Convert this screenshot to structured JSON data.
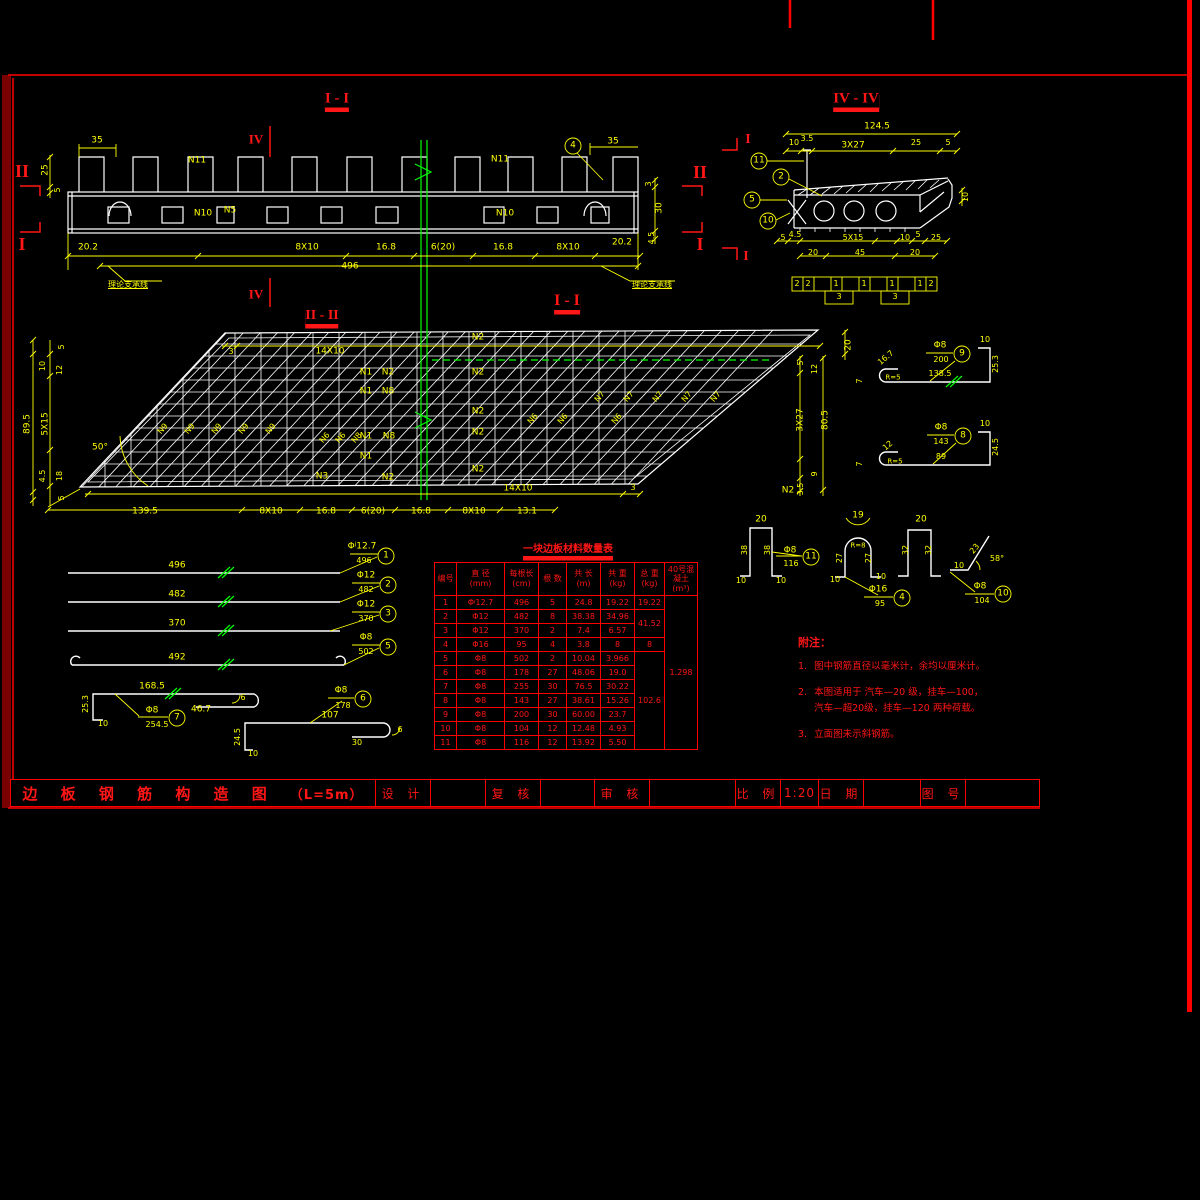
{
  "title_block": {
    "drawing_title": "边 板 钢 筋 构 造 图",
    "drawing_subtitle": "（L=5m）",
    "fields": [
      {
        "label": "设 计",
        "value": ""
      },
      {
        "label": "复 核",
        "value": ""
      },
      {
        "label": "审 核",
        "value": ""
      },
      {
        "label": "比 例",
        "value": "1:20"
      },
      {
        "label": "日 期",
        "value": ""
      },
      {
        "label": "图 号",
        "value": ""
      }
    ]
  },
  "table": {
    "title": "一块边板材料数量表",
    "headers": [
      "编号",
      "直 径\n(mm)",
      "每根长\n(cm)",
      "根 数",
      "共 长\n(m)",
      "共 重\n(kg)",
      "总 重\n(kg)",
      "40号混凝土\n(m³)"
    ],
    "rows": [
      [
        "1",
        "Φʲ12.7",
        "496",
        "5",
        "24.8",
        "19.22",
        {
          "t": "19.22"
        },
        {
          "t": "1.298",
          "rs": 11
        }
      ],
      [
        "2",
        "Φ12",
        "482",
        "8",
        "38.38",
        "34.96",
        {
          "t": "41.52",
          "rs": 2
        }
      ],
      [
        "3",
        "Φ12",
        "370",
        "2",
        "7.4",
        "6.57"
      ],
      [
        "4",
        "Φ16",
        "95",
        "4",
        "3.8",
        "8",
        {
          "t": "8"
        }
      ],
      [
        "5",
        "Φ8",
        "502",
        "2",
        "10.04",
        "3.966",
        {
          "t": "102.6",
          "rs": 7
        }
      ],
      [
        "6",
        "Φ8",
        "178",
        "27",
        "48.06",
        "19.0"
      ],
      [
        "7",
        "Φ8",
        "255",
        "30",
        "76.5",
        "30.22"
      ],
      [
        "8",
        "Φ8",
        "143",
        "27",
        "38.61",
        "15.26"
      ],
      [
        "9",
        "Φ8",
        "200",
        "30",
        "60.00",
        "23.7"
      ],
      [
        "10",
        "Φ8",
        "104",
        "12",
        "12.48",
        "4.93"
      ],
      [
        "11",
        "Φ8",
        "116",
        "12",
        "13.92",
        "5.50"
      ]
    ]
  },
  "notes": {
    "heading": "附注：",
    "items": [
      {
        "num": "1.",
        "text": "图中钢筋直径以毫米计，余均以厘米计。"
      },
      {
        "num": "2.",
        "text": "本图适用于 汽车—20 级，挂车—100，\n汽车—超20级，挂车—120 两种荷载。"
      },
      {
        "num": "3.",
        "text": "立面图未示斜钢筋。"
      }
    ]
  },
  "colors": {
    "background": "#000000",
    "linework": "#ffffff",
    "dimension": "#ffff00",
    "accent": "#ff0000",
    "breakline": "#00ff00",
    "frame_dark": "#7a0101"
  },
  "annotations": [
    {
      "x": 337,
      "y": 100,
      "t": "I - I",
      "c": "r",
      "s": 15,
      "b": 1,
      "f": 1,
      "u": 2,
      "n": "view-title-elevation"
    },
    {
      "x": 856,
      "y": 100,
      "t": "IV - IV",
      "c": "r",
      "s": 15,
      "b": 1,
      "f": 1,
      "u": 2,
      "n": "view-title-section-iv"
    },
    {
      "x": 322,
      "y": 317,
      "t": "II - II",
      "c": "r",
      "s": 14,
      "b": 1,
      "f": 1,
      "u": 2,
      "n": "view-title-plan"
    },
    {
      "x": 567,
      "y": 302,
      "t": "I - I",
      "c": "r",
      "s": 16,
      "b": 1,
      "f": 1,
      "u": 2,
      "n": "section-cut-title"
    },
    {
      "x": 22,
      "y": 171,
      "t": "II",
      "c": "r",
      "s": 18,
      "b": 1,
      "f": 1,
      "n": "section-marker"
    },
    {
      "x": 22,
      "y": 244,
      "t": "I",
      "c": "r",
      "s": 18,
      "b": 1,
      "f": 1,
      "n": "section-marker"
    },
    {
      "x": 700,
      "y": 172,
      "t": "II",
      "c": "r",
      "s": 18,
      "b": 1,
      "f": 1,
      "n": "section-marker"
    },
    {
      "x": 700,
      "y": 244,
      "t": "I",
      "c": "r",
      "s": 18,
      "b": 1,
      "f": 1,
      "n": "section-marker"
    },
    {
      "x": 256,
      "y": 139,
      "t": "IV",
      "c": "r",
      "s": 13,
      "b": 1,
      "f": 1,
      "n": "section-marker"
    },
    {
      "x": 256,
      "y": 294,
      "t": "IV",
      "c": "r",
      "s": 13,
      "b": 1,
      "f": 1,
      "n": "section-marker"
    },
    {
      "x": 748,
      "y": 140,
      "t": "I",
      "c": "r",
      "s": 14,
      "b": 1,
      "f": 1,
      "n": "section-marker"
    },
    {
      "x": 746,
      "y": 257,
      "t": "I",
      "c": "r",
      "s": 14,
      "b": 1,
      "f": 1,
      "n": "section-marker"
    },
    {
      "x": 97,
      "y": 141,
      "t": "35"
    },
    {
      "x": 46,
      "y": 170,
      "t": "25",
      "r": -90
    },
    {
      "x": 58,
      "y": 190,
      "t": "5",
      "r": -90,
      "s": 8
    },
    {
      "x": 613,
      "y": 142,
      "t": "35"
    },
    {
      "x": 649,
      "y": 184,
      "t": "3",
      "r": -90,
      "s": 8
    },
    {
      "x": 660,
      "y": 208,
      "t": "30",
      "r": -90
    },
    {
      "x": 652,
      "y": 238,
      "t": "4.5",
      "r": -90,
      "s": 8
    },
    {
      "x": 88,
      "y": 248,
      "t": "20.2"
    },
    {
      "x": 307,
      "y": 248,
      "t": "8X10"
    },
    {
      "x": 386,
      "y": 248,
      "t": "16.8"
    },
    {
      "x": 443,
      "y": 248,
      "t": "6(20)"
    },
    {
      "x": 503,
      "y": 248,
      "t": "16.8"
    },
    {
      "x": 568,
      "y": 248,
      "t": "8X10"
    },
    {
      "x": 622,
      "y": 243,
      "t": "20.2"
    },
    {
      "x": 350,
      "y": 267,
      "t": "496"
    },
    {
      "x": 197,
      "y": 161,
      "t": "N11",
      "n": "bar-label"
    },
    {
      "x": 203,
      "y": 214,
      "t": "N10",
      "n": "bar-label"
    },
    {
      "x": 230,
      "y": 211,
      "t": "N5",
      "n": "bar-label"
    },
    {
      "x": 500,
      "y": 160,
      "t": "N11",
      "n": "bar-label"
    },
    {
      "x": 505,
      "y": 214,
      "t": "N10",
      "n": "bar-label"
    },
    {
      "x": 128,
      "y": 285,
      "t": "理论支承线",
      "s": 8,
      "u": 1,
      "n": "support-line-label"
    },
    {
      "x": 652,
      "y": 285,
      "t": "理论支承线",
      "s": 8,
      "u": 1,
      "n": "support-line-label"
    },
    {
      "x": 573,
      "y": 146,
      "t": "4",
      "n": "callout-number"
    },
    {
      "x": 877,
      "y": 127,
      "t": "124.5"
    },
    {
      "x": 794,
      "y": 143,
      "t": "10",
      "s": 8
    },
    {
      "x": 807,
      "y": 139,
      "t": "3.5",
      "s": 8
    },
    {
      "x": 853,
      "y": 146,
      "t": "3X27"
    },
    {
      "x": 916,
      "y": 143,
      "t": "25",
      "s": 8
    },
    {
      "x": 948,
      "y": 143,
      "t": "5",
      "s": 8
    },
    {
      "x": 966,
      "y": 197,
      "t": "10",
      "r": -90,
      "s": 8
    },
    {
      "x": 759,
      "y": 161,
      "t": "11",
      "n": "callout-number"
    },
    {
      "x": 781,
      "y": 177,
      "t": "2",
      "n": "callout-number"
    },
    {
      "x": 752,
      "y": 200,
      "t": "5",
      "n": "callout-number"
    },
    {
      "x": 768,
      "y": 221,
      "t": "10",
      "n": "callout-number"
    },
    {
      "x": 783,
      "y": 238,
      "t": "5",
      "s": 8
    },
    {
      "x": 795,
      "y": 235,
      "t": "4.5",
      "s": 8
    },
    {
      "x": 853,
      "y": 238,
      "t": "5X15",
      "s": 8
    },
    {
      "x": 905,
      "y": 238,
      "t": "10",
      "s": 8
    },
    {
      "x": 918,
      "y": 235,
      "t": "5",
      "s": 8
    },
    {
      "x": 936,
      "y": 238,
      "t": "25",
      "s": 8
    },
    {
      "x": 813,
      "y": 253,
      "t": "20",
      "s": 8
    },
    {
      "x": 860,
      "y": 253,
      "t": "45",
      "s": 8
    },
    {
      "x": 915,
      "y": 253,
      "t": "20",
      "s": 8
    },
    {
      "x": 797,
      "y": 284,
      "t": "2",
      "s": 8
    },
    {
      "x": 808,
      "y": 284,
      "t": "2",
      "s": 8
    },
    {
      "x": 836,
      "y": 284,
      "t": "1",
      "s": 8
    },
    {
      "x": 864,
      "y": 284,
      "t": "1",
      "s": 8
    },
    {
      "x": 892,
      "y": 284,
      "t": "1",
      "s": 8
    },
    {
      "x": 920,
      "y": 284,
      "t": "1",
      "s": 8
    },
    {
      "x": 931,
      "y": 284,
      "t": "2",
      "s": 8
    },
    {
      "x": 839,
      "y": 297,
      "t": "3",
      "s": 8
    },
    {
      "x": 895,
      "y": 297,
      "t": "3",
      "s": 8
    },
    {
      "x": 100,
      "y": 448,
      "t": "50°"
    },
    {
      "x": 231,
      "y": 352,
      "t": "3",
      "s": 8
    },
    {
      "x": 330,
      "y": 352,
      "t": "14X10"
    },
    {
      "x": 518,
      "y": 489,
      "t": "14X10"
    },
    {
      "x": 633,
      "y": 488,
      "t": "3",
      "s": 8
    },
    {
      "x": 145,
      "y": 512,
      "t": "139.5"
    },
    {
      "x": 271,
      "y": 512,
      "t": "8X10"
    },
    {
      "x": 326,
      "y": 512,
      "t": "16.8"
    },
    {
      "x": 373,
      "y": 512,
      "t": "6(20)"
    },
    {
      "x": 421,
      "y": 512,
      "t": "16.8"
    },
    {
      "x": 474,
      "y": 512,
      "t": "8X10"
    },
    {
      "x": 527,
      "y": 512,
      "t": "13.1"
    },
    {
      "x": 62,
      "y": 347,
      "t": "5",
      "r": -90,
      "s": 8
    },
    {
      "x": 43,
      "y": 366,
      "t": "10",
      "r": -90,
      "s": 8
    },
    {
      "x": 60,
      "y": 370,
      "t": "12",
      "r": -90,
      "s": 8
    },
    {
      "x": 28,
      "y": 424,
      "t": "89.5",
      "r": -90
    },
    {
      "x": 46,
      "y": 424,
      "t": "5X15",
      "r": -90
    },
    {
      "x": 43,
      "y": 476,
      "t": "4.5",
      "r": -90,
      "s": 8
    },
    {
      "x": 60,
      "y": 476,
      "t": "18",
      "r": -90,
      "s": 8
    },
    {
      "x": 62,
      "y": 498,
      "t": "5",
      "r": -90,
      "s": 8
    },
    {
      "x": 849,
      "y": 345,
      "t": "20",
      "r": -90
    },
    {
      "x": 801,
      "y": 363,
      "t": "5",
      "r": -90,
      "s": 8
    },
    {
      "x": 815,
      "y": 369,
      "t": "12",
      "r": -90,
      "s": 8
    },
    {
      "x": 801,
      "y": 420,
      "t": "3X27",
      "r": -90
    },
    {
      "x": 826,
      "y": 420,
      "t": "80.5",
      "r": -90
    },
    {
      "x": 815,
      "y": 474,
      "t": "9",
      "r": -90,
      "s": 8
    },
    {
      "x": 801,
      "y": 489,
      "t": "3.5",
      "r": -90,
      "s": 8
    },
    {
      "x": 366,
      "y": 373,
      "t": "N1",
      "n": "bar-label"
    },
    {
      "x": 388,
      "y": 373,
      "t": "N2",
      "n": "bar-label"
    },
    {
      "x": 366,
      "y": 392,
      "t": "N1",
      "n": "bar-label"
    },
    {
      "x": 388,
      "y": 392,
      "t": "N8",
      "n": "bar-label"
    },
    {
      "x": 366,
      "y": 437,
      "t": "N1",
      "n": "bar-label"
    },
    {
      "x": 389,
      "y": 437,
      "t": "N8",
      "n": "bar-label"
    },
    {
      "x": 366,
      "y": 457,
      "t": "N1",
      "n": "bar-label"
    },
    {
      "x": 322,
      "y": 477,
      "t": "N3",
      "n": "bar-label"
    },
    {
      "x": 388,
      "y": 478,
      "t": "N2",
      "n": "bar-label"
    },
    {
      "x": 478,
      "y": 338,
      "t": "N2",
      "n": "bar-label"
    },
    {
      "x": 478,
      "y": 373,
      "t": "N2",
      "n": "bar-label"
    },
    {
      "x": 478,
      "y": 412,
      "t": "N2",
      "n": "bar-label"
    },
    {
      "x": 478,
      "y": 433,
      "t": "N2",
      "n": "bar-label"
    },
    {
      "x": 478,
      "y": 470,
      "t": "N2",
      "n": "bar-label"
    },
    {
      "x": 788,
      "y": 491,
      "t": "N2",
      "n": "bar-label"
    },
    {
      "x": 163,
      "y": 429,
      "t": "N9",
      "r": -50,
      "s": 8,
      "n": "bar-label"
    },
    {
      "x": 190,
      "y": 429,
      "t": "N9",
      "r": -50,
      "s": 8,
      "n": "bar-label"
    },
    {
      "x": 217,
      "y": 429,
      "t": "N9",
      "r": -50,
      "s": 8,
      "n": "bar-label"
    },
    {
      "x": 244,
      "y": 429,
      "t": "N9",
      "r": -50,
      "s": 8,
      "n": "bar-label"
    },
    {
      "x": 271,
      "y": 429,
      "t": "N9",
      "r": -50,
      "s": 8,
      "n": "bar-label"
    },
    {
      "x": 325,
      "y": 438,
      "t": "N6",
      "r": -50,
      "s": 8,
      "n": "bar-label"
    },
    {
      "x": 341,
      "y": 438,
      "t": "N6",
      "r": -50,
      "s": 8,
      "n": "bar-label"
    },
    {
      "x": 357,
      "y": 438,
      "t": "N8",
      "r": -50,
      "s": 8,
      "n": "bar-label"
    },
    {
      "x": 533,
      "y": 419,
      "t": "N6",
      "r": -50,
      "s": 8,
      "n": "bar-label"
    },
    {
      "x": 563,
      "y": 419,
      "t": "N6",
      "r": -50,
      "s": 8,
      "n": "bar-label"
    },
    {
      "x": 617,
      "y": 419,
      "t": "N6",
      "r": -50,
      "s": 8,
      "n": "bar-label"
    },
    {
      "x": 600,
      "y": 397,
      "t": "N7",
      "r": -50,
      "s": 8,
      "n": "bar-label"
    },
    {
      "x": 629,
      "y": 397,
      "t": "N7",
      "r": -50,
      "s": 8,
      "n": "bar-label"
    },
    {
      "x": 658,
      "y": 397,
      "t": "N7",
      "r": -50,
      "s": 8,
      "n": "bar-label"
    },
    {
      "x": 687,
      "y": 397,
      "t": "N7",
      "r": -50,
      "s": 8,
      "n": "bar-label"
    },
    {
      "x": 716,
      "y": 397,
      "t": "N7",
      "r": -50,
      "s": 8,
      "n": "bar-label"
    },
    {
      "x": 177,
      "y": 566,
      "t": "496"
    },
    {
      "x": 177,
      "y": 595,
      "t": "482"
    },
    {
      "x": 177,
      "y": 624,
      "t": "370"
    },
    {
      "x": 177,
      "y": 658,
      "t": "492"
    },
    {
      "x": 362,
      "y": 547,
      "t": "Φʲ12.7"
    },
    {
      "x": 364,
      "y": 561,
      "t": "496",
      "s": 8
    },
    {
      "x": 386,
      "y": 556,
      "t": "1",
      "n": "callout-number"
    },
    {
      "x": 366,
      "y": 576,
      "t": "Φ12"
    },
    {
      "x": 366,
      "y": 590,
      "t": "482",
      "s": 8
    },
    {
      "x": 388,
      "y": 585,
      "t": "2",
      "n": "callout-number"
    },
    {
      "x": 366,
      "y": 605,
      "t": "Φ12"
    },
    {
      "x": 366,
      "y": 619,
      "t": "370",
      "s": 8
    },
    {
      "x": 388,
      "y": 614,
      "t": "3",
      "n": "callout-number"
    },
    {
      "x": 366,
      "y": 638,
      "t": "Φ8"
    },
    {
      "x": 366,
      "y": 652,
      "t": "502",
      "s": 8
    },
    {
      "x": 388,
      "y": 647,
      "t": "5",
      "n": "callout-number"
    },
    {
      "x": 152,
      "y": 687,
      "t": "168.5"
    },
    {
      "x": 201,
      "y": 710,
      "t": "46.7"
    },
    {
      "x": 243,
      "y": 698,
      "t": "6",
      "s": 8
    },
    {
      "x": 86,
      "y": 704,
      "t": "25.3",
      "r": -90,
      "s": 8
    },
    {
      "x": 103,
      "y": 724,
      "t": "10",
      "s": 8
    },
    {
      "x": 152,
      "y": 711,
      "t": "Φ8"
    },
    {
      "x": 157,
      "y": 725,
      "t": "254.5",
      "s": 8
    },
    {
      "x": 177,
      "y": 718,
      "t": "7",
      "n": "callout-number"
    },
    {
      "x": 330,
      "y": 716,
      "t": "107"
    },
    {
      "x": 357,
      "y": 743,
      "t": "30",
      "s": 8
    },
    {
      "x": 400,
      "y": 730,
      "t": "6",
      "s": 8
    },
    {
      "x": 238,
      "y": 737,
      "t": "24.5",
      "r": -90,
      "s": 8
    },
    {
      "x": 253,
      "y": 754,
      "t": "10",
      "s": 8
    },
    {
      "x": 341,
      "y": 691,
      "t": "Φ8"
    },
    {
      "x": 343,
      "y": 706,
      "t": "178",
      "s": 8
    },
    {
      "x": 363,
      "y": 699,
      "t": "6",
      "n": "callout-number"
    },
    {
      "x": 940,
      "y": 346,
      "t": "Φ8"
    },
    {
      "x": 941,
      "y": 360,
      "t": "200",
      "s": 8
    },
    {
      "x": 962,
      "y": 354,
      "t": "9",
      "n": "callout-number"
    },
    {
      "x": 985,
      "y": 340,
      "t": "10",
      "s": 8
    },
    {
      "x": 996,
      "y": 364,
      "t": "25.3",
      "r": -90,
      "s": 8
    },
    {
      "x": 940,
      "y": 374,
      "t": "138.5",
      "s": 8
    },
    {
      "x": 886,
      "y": 358,
      "t": "16.7",
      "r": -40,
      "s": 8
    },
    {
      "x": 893,
      "y": 378,
      "t": "R=5",
      "s": 7
    },
    {
      "x": 860,
      "y": 381,
      "t": "7",
      "r": -90,
      "s": 8
    },
    {
      "x": 941,
      "y": 428,
      "t": "Φ8"
    },
    {
      "x": 941,
      "y": 442,
      "t": "143",
      "s": 8
    },
    {
      "x": 963,
      "y": 436,
      "t": "8",
      "n": "callout-number"
    },
    {
      "x": 985,
      "y": 424,
      "t": "10",
      "s": 8
    },
    {
      "x": 996,
      "y": 447,
      "t": "24.5",
      "r": -90,
      "s": 8
    },
    {
      "x": 941,
      "y": 457,
      "t": "89",
      "s": 8
    },
    {
      "x": 888,
      "y": 446,
      "t": "12",
      "r": -40,
      "s": 8
    },
    {
      "x": 895,
      "y": 462,
      "t": "R=5",
      "s": 7
    },
    {
      "x": 860,
      "y": 464,
      "t": "7",
      "r": -90,
      "s": 8
    },
    {
      "x": 761,
      "y": 520,
      "t": "20"
    },
    {
      "x": 745,
      "y": 550,
      "t": "38",
      "r": -90,
      "s": 8
    },
    {
      "x": 768,
      "y": 550,
      "t": "38",
      "r": -90,
      "s": 8
    },
    {
      "x": 741,
      "y": 581,
      "t": "10",
      "s": 8
    },
    {
      "x": 781,
      "y": 581,
      "t": "10",
      "s": 8
    },
    {
      "x": 790,
      "y": 551,
      "t": "Φ8"
    },
    {
      "x": 791,
      "y": 564,
      "t": "116",
      "s": 8
    },
    {
      "x": 811,
      "y": 557,
      "t": "11",
      "n": "callout-number"
    },
    {
      "x": 858,
      "y": 516,
      "t": "19"
    },
    {
      "x": 858,
      "y": 546,
      "t": "R=8",
      "s": 7
    },
    {
      "x": 840,
      "y": 558,
      "t": "27",
      "r": -90,
      "s": 8
    },
    {
      "x": 869,
      "y": 558,
      "t": "27",
      "r": -90,
      "s": 8
    },
    {
      "x": 835,
      "y": 580,
      "t": "10",
      "s": 8
    },
    {
      "x": 881,
      "y": 577,
      "t": "10",
      "s": 8
    },
    {
      "x": 878,
      "y": 590,
      "t": "Φ16"
    },
    {
      "x": 880,
      "y": 604,
      "t": "95",
      "s": 8
    },
    {
      "x": 902,
      "y": 598,
      "t": "4",
      "n": "callout-number"
    },
    {
      "x": 921,
      "y": 520,
      "t": "20"
    },
    {
      "x": 906,
      "y": 550,
      "t": "32",
      "r": -90,
      "s": 8
    },
    {
      "x": 929,
      "y": 550,
      "t": "32",
      "r": -90,
      "s": 8
    },
    {
      "x": 959,
      "y": 566,
      "t": "10",
      "s": 8
    },
    {
      "x": 975,
      "y": 549,
      "t": "23",
      "r": -50,
      "s": 8
    },
    {
      "x": 997,
      "y": 559,
      "t": "58°",
      "s": 8
    },
    {
      "x": 980,
      "y": 587,
      "t": "Φ8"
    },
    {
      "x": 982,
      "y": 601,
      "t": "104",
      "s": 8
    },
    {
      "x": 1003,
      "y": 594,
      "t": "10",
      "n": "callout-number"
    },
    {
      "x": 568,
      "y": 551,
      "t": "一块边板材料数量表",
      "c": "r",
      "s": 10,
      "b": 1,
      "u": 2,
      "n": "table-title"
    }
  ]
}
